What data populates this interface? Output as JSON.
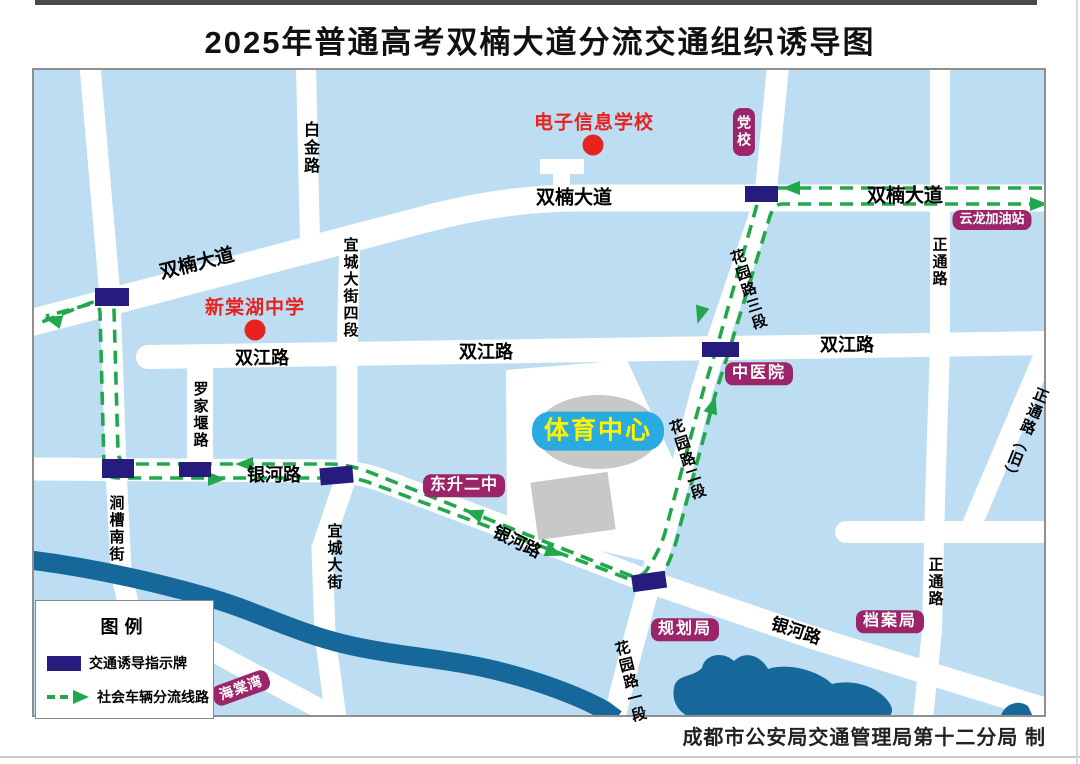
{
  "title": "2025年普通高考双楠大道分流交通组织诱导图",
  "credit": "成都市公安局交通管理局第十二分局 制",
  "legend": {
    "title": "图例",
    "items": [
      {
        "symbol": "guidance-sign",
        "label": "交通诱导指示牌"
      },
      {
        "symbol": "route-arrow",
        "label": "社会车辆分流线路"
      }
    ]
  },
  "schools": [
    {
      "name": "电子信息学校"
    },
    {
      "name": "新棠湖中学"
    }
  ],
  "pois": [
    {
      "name": "党校"
    },
    {
      "name": "云龙加油站"
    },
    {
      "name": "中医院"
    },
    {
      "name": "体育中心"
    },
    {
      "name": "东升二中"
    },
    {
      "name": "规划局"
    },
    {
      "name": "档案局"
    },
    {
      "name": "海棠湾"
    }
  ],
  "road_labels": [
    {
      "text": "白金路"
    },
    {
      "text": "双楠大道"
    },
    {
      "text": "双楠大道"
    },
    {
      "text": "双楠大道"
    },
    {
      "text": "宜城大街四段"
    },
    {
      "text": "双江路"
    },
    {
      "text": "双江路"
    },
    {
      "text": "双江路"
    },
    {
      "text": "罗家堰路"
    },
    {
      "text": "银河路"
    },
    {
      "text": "涧槽南街"
    },
    {
      "text": "宜城大街"
    },
    {
      "text": "银河路"
    },
    {
      "text": "银河路"
    },
    {
      "text": "花园路三段"
    },
    {
      "text": "花园路二段"
    },
    {
      "text": "花园路一段"
    },
    {
      "text": "正通路"
    },
    {
      "text": "正通路（旧）"
    },
    {
      "text": "正通路"
    }
  ],
  "colors": {
    "background": "#bdddf2",
    "road": "#ffffff",
    "water": "#16689b",
    "route_green": "#22a84c",
    "sign_navy": "#251c7d",
    "badge_purple": "#9c2569",
    "school_red": "#e8231f",
    "sports_blue": "#29abe2",
    "sports_yellow": "#fff200"
  }
}
